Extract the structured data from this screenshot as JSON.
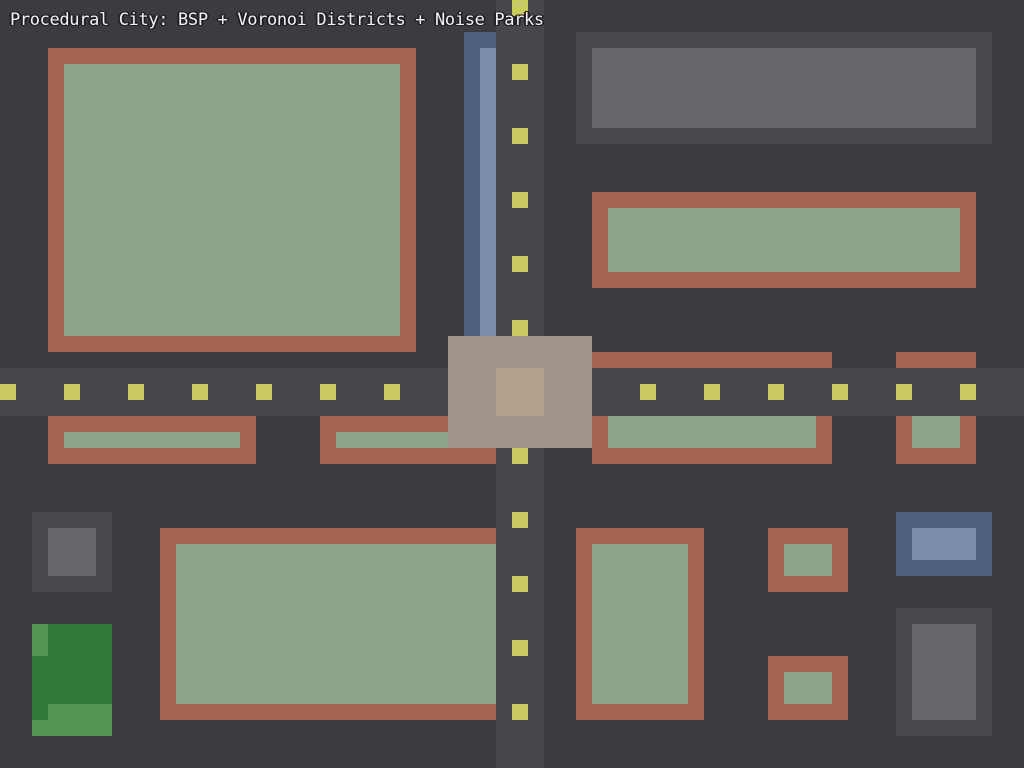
{
  "title": "Procedural City: BSP + Voronoi Districts + Noise Parks",
  "canvas": {
    "width": 1024,
    "height": 768
  },
  "palette": {
    "background": "#3b3b40",
    "road": "#47474b",
    "lane_dash": "#c9ca62",
    "building_wall": "#a46452",
    "building_roof": "#8da28a",
    "block_dark": "#47474c",
    "block_light": "#65656b",
    "water_dark": "#4f6080",
    "water_light": "#7a8caa",
    "park_dark": "#2f7a36",
    "park_light": "#529551",
    "plaza": "#a0968b",
    "plaza_inner": "#b4a18d",
    "title_text": "#f2f2f2",
    "title_outline": "#222226"
  },
  "scene": {
    "roads": [
      {
        "name": "road-vertical",
        "x": 496,
        "y": 0,
        "w": 48,
        "h": 768
      },
      {
        "name": "road-horizontal",
        "x": 0,
        "y": 368,
        "w": 1024,
        "h": 48
      }
    ],
    "lane_dashes": {
      "size": 16,
      "vertical": {
        "x": 512,
        "ys": [
          0,
          64,
          128,
          192,
          256,
          320,
          384,
          448,
          512,
          576,
          640,
          704
        ]
      },
      "horizontal": {
        "y": 384,
        "xs": [
          0,
          64,
          128,
          192,
          256,
          320,
          384,
          448,
          512,
          576,
          640,
          704,
          768,
          832,
          896,
          960
        ]
      }
    },
    "features": [
      {
        "name": "river-bank",
        "x": 464,
        "y": 32,
        "w": 32,
        "h": 304,
        "color": "water_dark"
      },
      {
        "name": "river-water",
        "x": 480,
        "y": 48,
        "w": 16,
        "h": 288,
        "color": "water_light"
      },
      {
        "name": "building-nw-wall",
        "x": 48,
        "y": 48,
        "w": 368,
        "h": 304,
        "color": "building_wall"
      },
      {
        "name": "building-nw-roof",
        "x": 64,
        "y": 64,
        "w": 336,
        "h": 272,
        "color": "building_roof"
      },
      {
        "name": "block-ne-outer",
        "x": 576,
        "y": 32,
        "w": 416,
        "h": 112,
        "color": "block_dark"
      },
      {
        "name": "block-ne-inner",
        "x": 592,
        "y": 48,
        "w": 384,
        "h": 80,
        "color": "block_light"
      },
      {
        "name": "building-e-wall",
        "x": 592,
        "y": 192,
        "w": 384,
        "h": 96,
        "color": "building_wall"
      },
      {
        "name": "building-e-roof",
        "x": 608,
        "y": 208,
        "w": 352,
        "h": 64,
        "color": "building_roof"
      },
      {
        "name": "building-sliver-center",
        "x": 592,
        "y": 352,
        "w": 240,
        "h": 16,
        "color": "building_wall"
      },
      {
        "name": "building-sliver-east",
        "x": 896,
        "y": 352,
        "w": 80,
        "h": 16,
        "color": "building_wall"
      },
      {
        "name": "building-s1-wall",
        "x": 48,
        "y": 416,
        "w": 208,
        "h": 48,
        "color": "building_wall"
      },
      {
        "name": "building-s1-roof",
        "x": 64,
        "y": 432,
        "w": 176,
        "h": 16,
        "color": "building_roof"
      },
      {
        "name": "building-s2-wall",
        "x": 320,
        "y": 416,
        "w": 176,
        "h": 48,
        "color": "building_wall"
      },
      {
        "name": "building-s2-roof",
        "x": 336,
        "y": 432,
        "w": 144,
        "h": 16,
        "color": "building_roof"
      },
      {
        "name": "building-s3-wall",
        "x": 592,
        "y": 416,
        "w": 240,
        "h": 48,
        "color": "building_wall"
      },
      {
        "name": "building-s3-roof",
        "x": 608,
        "y": 416,
        "w": 208,
        "h": 32,
        "color": "building_roof"
      },
      {
        "name": "building-s4-wall",
        "x": 896,
        "y": 416,
        "w": 80,
        "h": 48,
        "color": "building_wall"
      },
      {
        "name": "building-s4-roof",
        "x": 912,
        "y": 416,
        "w": 48,
        "h": 32,
        "color": "building_roof"
      },
      {
        "name": "block-sw-outer",
        "x": 32,
        "y": 512,
        "w": 80,
        "h": 80,
        "color": "block_dark"
      },
      {
        "name": "block-sw-inner",
        "x": 48,
        "y": 528,
        "w": 48,
        "h": 48,
        "color": "block_light"
      },
      {
        "name": "park-base",
        "x": 32,
        "y": 624,
        "w": 80,
        "h": 112,
        "color": "park_dark"
      },
      {
        "name": "park-patch-nw",
        "x": 32,
        "y": 624,
        "w": 16,
        "h": 32,
        "color": "park_light"
      },
      {
        "name": "park-patch-s1",
        "x": 48,
        "y": 704,
        "w": 64,
        "h": 16,
        "color": "park_light"
      },
      {
        "name": "park-patch-s2",
        "x": 32,
        "y": 720,
        "w": 80,
        "h": 16,
        "color": "park_light"
      },
      {
        "name": "building-sbig-wall",
        "x": 160,
        "y": 528,
        "w": 336,
        "h": 192,
        "color": "building_wall"
      },
      {
        "name": "building-sbig-roof",
        "x": 176,
        "y": 544,
        "w": 320,
        "h": 160,
        "color": "building_roof"
      },
      {
        "name": "building-smid-wall",
        "x": 576,
        "y": 528,
        "w": 128,
        "h": 192,
        "color": "building_wall"
      },
      {
        "name": "building-smid-roof",
        "x": 592,
        "y": 544,
        "w": 96,
        "h": 160,
        "color": "building_roof"
      },
      {
        "name": "building-se1-wall",
        "x": 768,
        "y": 528,
        "w": 80,
        "h": 64,
        "color": "building_wall"
      },
      {
        "name": "building-se1-roof",
        "x": 784,
        "y": 544,
        "w": 48,
        "h": 32,
        "color": "building_roof"
      },
      {
        "name": "building-se2-wall",
        "x": 768,
        "y": 656,
        "w": 80,
        "h": 64,
        "color": "building_wall"
      },
      {
        "name": "building-se2-roof",
        "x": 784,
        "y": 672,
        "w": 48,
        "h": 32,
        "color": "building_roof"
      },
      {
        "name": "pond-bank",
        "x": 896,
        "y": 512,
        "w": 96,
        "h": 64,
        "color": "water_dark"
      },
      {
        "name": "pond-water",
        "x": 912,
        "y": 528,
        "w": 64,
        "h": 32,
        "color": "water_light"
      },
      {
        "name": "block-se-outer",
        "x": 896,
        "y": 608,
        "w": 96,
        "h": 128,
        "color": "block_dark"
      },
      {
        "name": "block-se-inner",
        "x": 912,
        "y": 624,
        "w": 64,
        "h": 96,
        "color": "block_light"
      },
      {
        "name": "plaza-outer",
        "x": 448,
        "y": 336,
        "w": 144,
        "h": 112,
        "color": "plaza"
      },
      {
        "name": "plaza-inner",
        "x": 496,
        "y": 368,
        "w": 48,
        "h": 48,
        "color": "plaza_inner"
      }
    ]
  }
}
